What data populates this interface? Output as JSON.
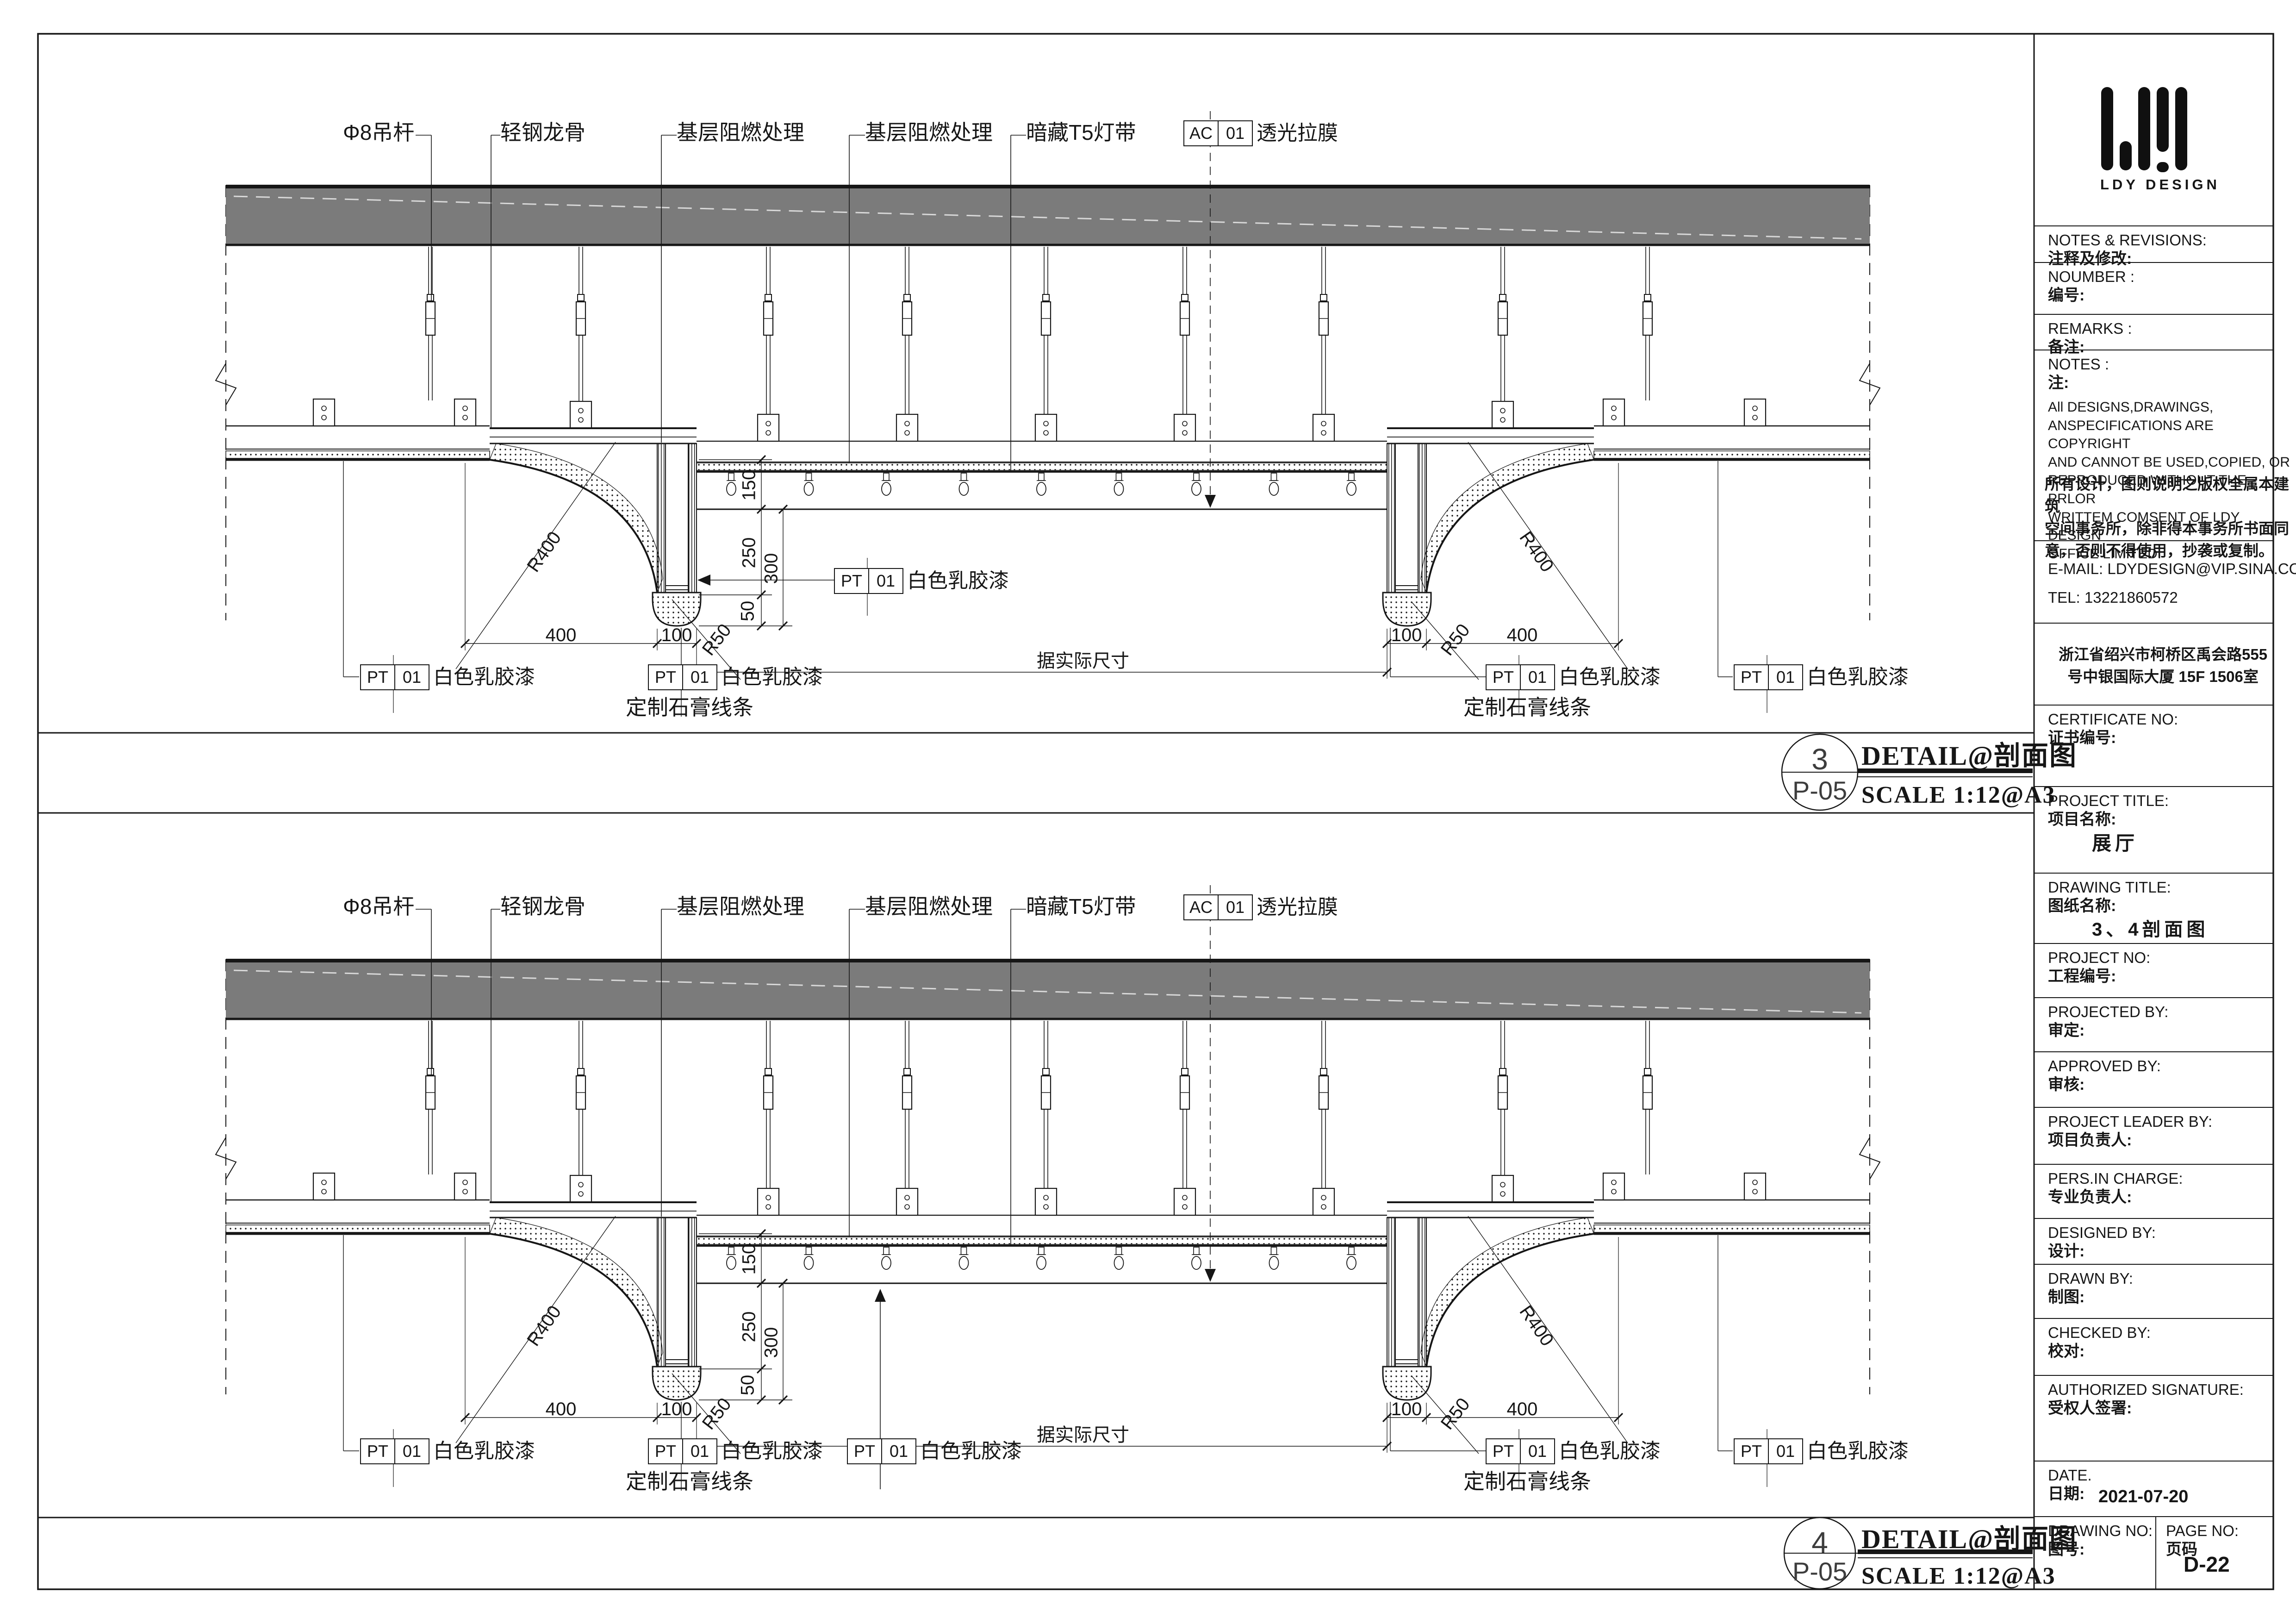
{
  "annotations": {
    "top_labels": [
      "Φ8吊杆",
      "轻钢龙骨",
      "基层阻燃处理",
      "基层阻燃处理",
      "暗藏T5灯带"
    ],
    "membrane_tag": {
      "code": "AC",
      "num": "01",
      "label": "透光拉膜"
    },
    "paint_tag": {
      "code": "PT",
      "num": "01",
      "label": "白色乳胶漆"
    },
    "moulding_label": "定制石膏线条",
    "dims": {
      "w400": "400",
      "w100": "100",
      "h150": "150",
      "h250": "250",
      "h300": "300",
      "h50": "50",
      "r400": "R400",
      "r50": "R50",
      "span_note": "据实际尺寸"
    }
  },
  "details": [
    {
      "number": "3",
      "sheet_ref": "P-05",
      "title": "DETAIL@剖面图",
      "scale": "SCALE 1:12@A3"
    },
    {
      "number": "4",
      "sheet_ref": "P-05",
      "title": "DETAIL@剖面图",
      "scale": "SCALE 1:12@A3"
    }
  ],
  "title_block": {
    "logo_text": "LDY DESIGN",
    "rows": [
      {
        "en": "NOTES & REVISIONS:",
        "cn": "注释及修改:"
      },
      {
        "en": "NOUMBER :",
        "cn": "编号:"
      },
      {
        "en": "REMARKS :",
        "cn": "备注:"
      },
      {
        "en": "NOTES :",
        "cn": "注:",
        "body_en": "All DESIGNS,DRAWINGS,\nANSPECIFICATIONS ARE COPYRIGHT\nAND CANNOT BE USED,COPIED, OR\nREPRODUCED WITHOUT THE PRLOR\nWRITTEM COMSENT OF LDY DESIGN\nOFFICE LIMITED.",
        "body_cn": "所有设计，图则说明之版权全属本建筑\n空间事务所，除非得本事务所书面同\n意，否则不得使用，抄袭或复制。"
      },
      {
        "lines": [
          "E-MAIL:   LDYDESIGN@VIP.SINA.COM",
          "TEL:        13221860572"
        ]
      },
      {
        "address": "浙江省绍兴市柯桥区禹会路555\n号中银国际大厦  15F  1506室"
      },
      {
        "en": "CERTIFICATE NO:",
        "cn": "证书编号:"
      },
      {
        "en": "PROJECT TITLE:",
        "cn": "项目名称:",
        "value": "展厅"
      },
      {
        "en": "DRAWING TITLE:",
        "cn": "图纸名称:",
        "value": "3、4剖面图"
      },
      {
        "en": "PROJECT  NO:",
        "cn": "工程编号:"
      },
      {
        "en": "PROJECTED  BY:",
        "cn": "审定:"
      },
      {
        "en": "APPROVED  BY:",
        "cn": "审核:"
      },
      {
        "en": "PROJECT LEADER BY:",
        "cn": "项目负责人:"
      },
      {
        "en": "PERS.IN CHARGE:",
        "cn": "专业负责人:"
      },
      {
        "en": "DESIGNED BY:",
        "cn": "设计:"
      },
      {
        "en": "DRAWN BY:",
        "cn": "制图:"
      },
      {
        "en": "CHECKED BY:",
        "cn": "校对:"
      },
      {
        "en": "AUTHORIZED  SIGNATURE:",
        "cn": "受权人签署:"
      },
      {
        "en": "DATE.",
        "cn": "日期:",
        "value": "2021-07-20"
      },
      {
        "split_left": {
          "en": "DRAWING NO:",
          "cn": "图号:"
        },
        "split_right": {
          "en": "PAGE NO:",
          "cn": "页码",
          "value": "D-22"
        }
      }
    ]
  }
}
